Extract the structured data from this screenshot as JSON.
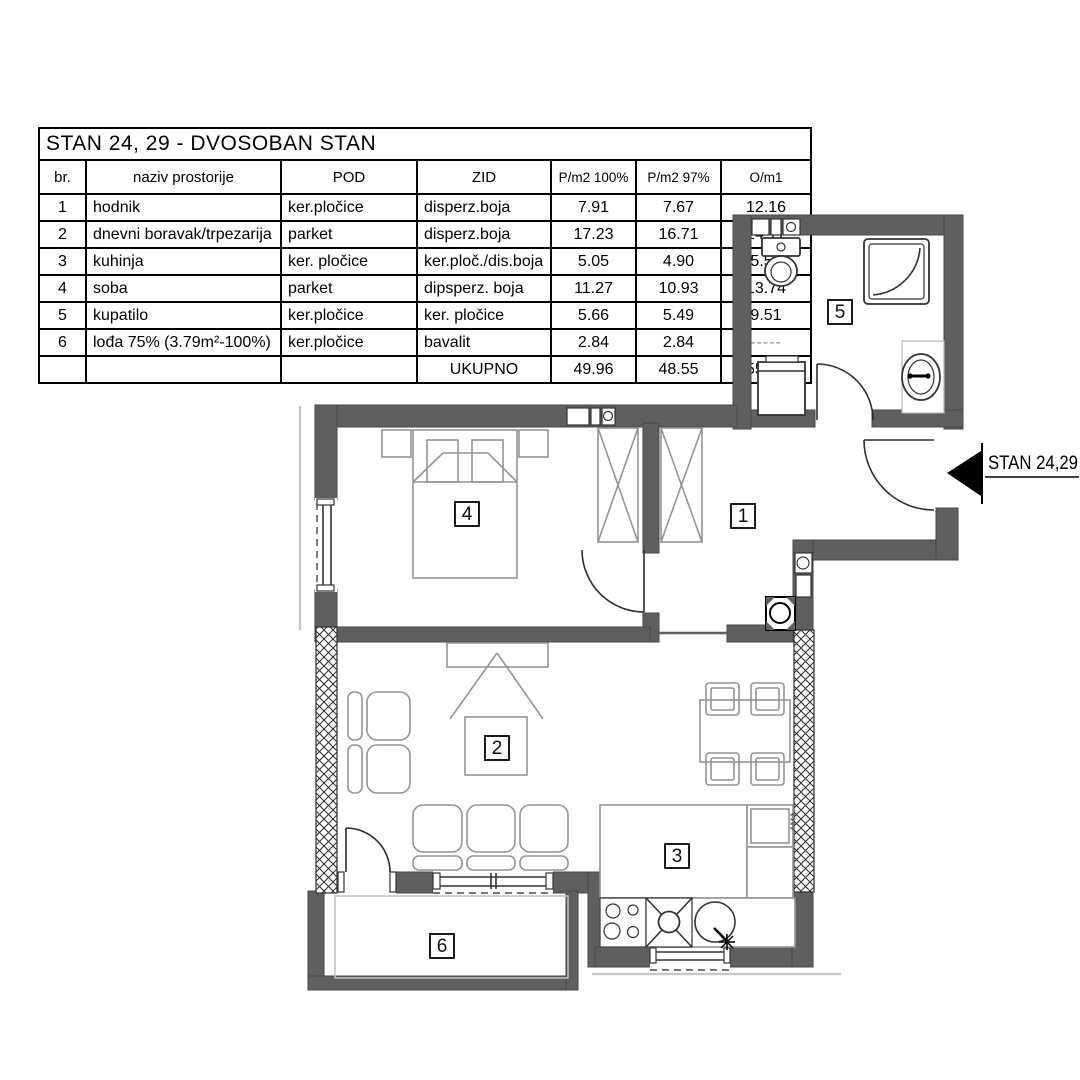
{
  "table": {
    "title": "STAN  24, 29 - DVOSOBAN STAN",
    "columns": [
      "br.",
      "naziv prostorije",
      "POD",
      "ZID",
      "P/m2 100%",
      "P/m2 97%",
      "O/m1"
    ],
    "rows": [
      {
        "br": "1",
        "naziv": "hodnik",
        "pod": "ker.pločice",
        "zid": "disperz.boja",
        "p100": "7.91",
        "p97": "7.67",
        "o": "12.16"
      },
      {
        "br": "2",
        "naziv": "dnevni boravak/trpezarija",
        "pod": "parket",
        "zid": "disperz.boja",
        "p100": "17.23",
        "p97": "16.71",
        "o": "14.17"
      },
      {
        "br": "3",
        "naziv": "kuhinja",
        "pod": "ker. pločice",
        "zid": "ker.ploč./dis.boja",
        "p100": "5.05",
        "p97": "4.90",
        "o": "5.55"
      },
      {
        "br": "4",
        "naziv": "soba",
        "pod": "parket",
        "zid": "dipsperz. boja",
        "p100": "11.27",
        "p97": "10.93",
        "o": "13.74"
      },
      {
        "br": "5",
        "naziv": "kupatilo",
        "pod": "ker.pločice",
        "zid": "ker. pločice",
        "p100": "5.66",
        "p97": "5.49",
        "o": "9.51"
      },
      {
        "br": "6",
        "naziv": "lođa 75%  (3.79m²-100%)",
        "pod": "ker.pločice",
        "zid": "bavalit",
        "p100": "2.84",
        "p97": "2.84",
        "o": "-----"
      }
    ],
    "total": {
      "label": "UKUPNO",
      "p100": "49.96",
      "p97": "48.55",
      "o": "55.13"
    }
  },
  "plan": {
    "entrance_label": "STAN 24,29",
    "room_labels": [
      "1",
      "2",
      "3",
      "4",
      "5",
      "6"
    ],
    "freezer_stars": "****"
  },
  "colors": {
    "wall": "#5f5f5f",
    "hatch_line": "#2b2b2b",
    "furniture_line": "#949494",
    "fixture_line": "#333333",
    "light_line": "#c9c9c9",
    "text": "#000000"
  }
}
